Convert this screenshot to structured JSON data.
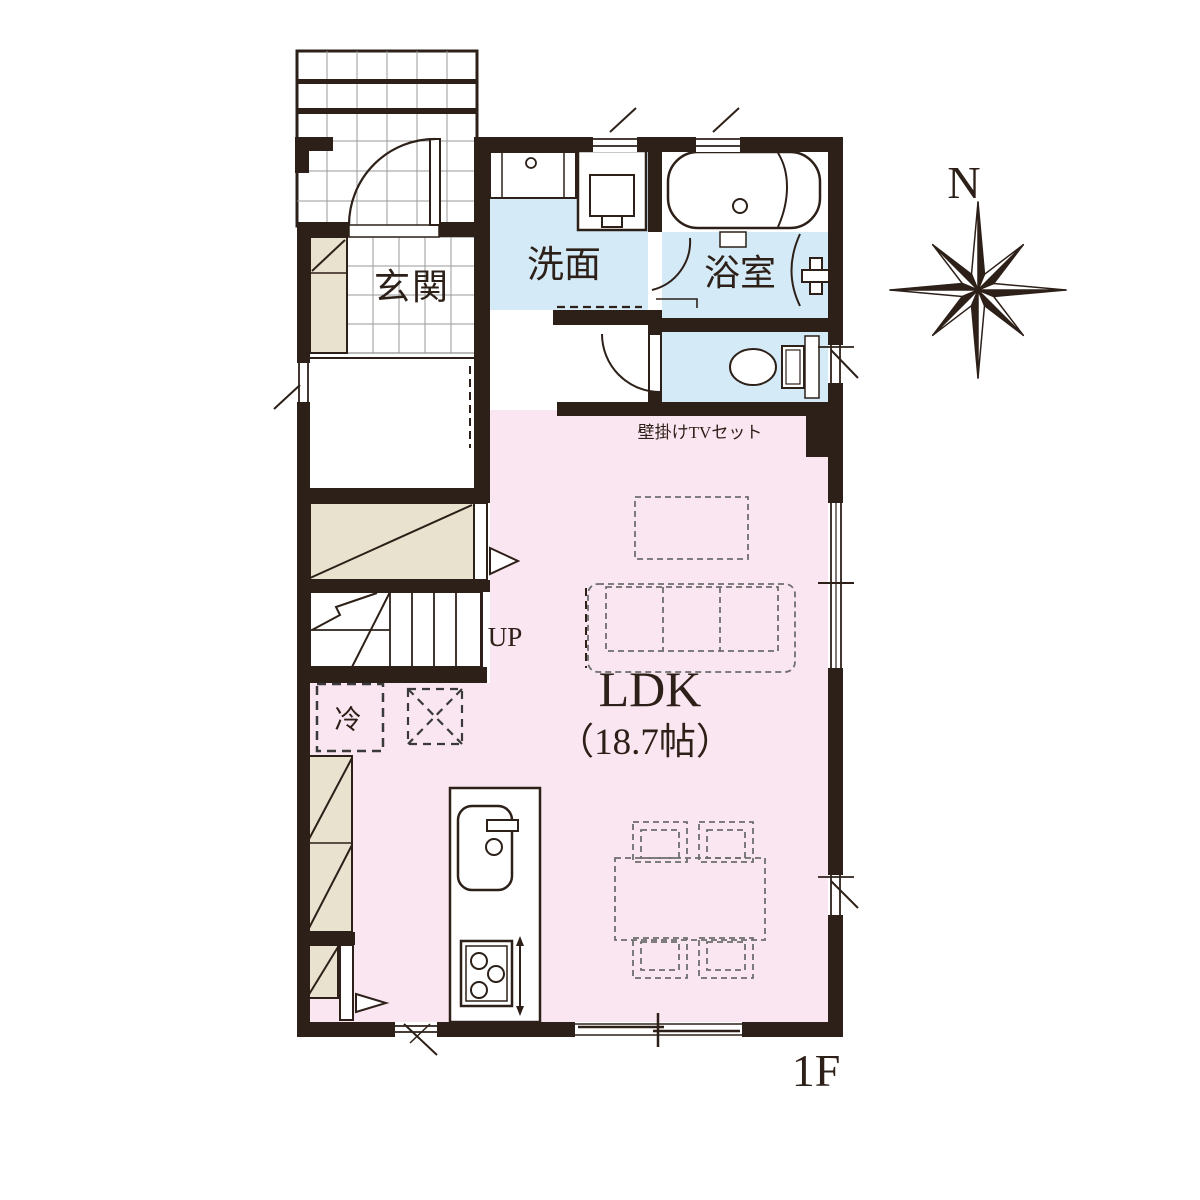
{
  "floor_plan": {
    "floor_label": "1F",
    "compass_label": "N",
    "rooms": {
      "genkan": "玄関",
      "washroom": "洗面",
      "bathroom": "浴室",
      "ldk_name": "LDK",
      "ldk_size": "（18.7帖）"
    },
    "annotations": {
      "tv": "壁掛けTVセット",
      "fridge": "冷",
      "stairs_up": "UP"
    },
    "colors": {
      "wall": "#2d2019",
      "wet_room_fill": "#d4eaf7",
      "ldk_fill": "#fae6f0",
      "closet_fill": "#e9e2cf",
      "furniture_dash": "#6e6e6e"
    }
  }
}
